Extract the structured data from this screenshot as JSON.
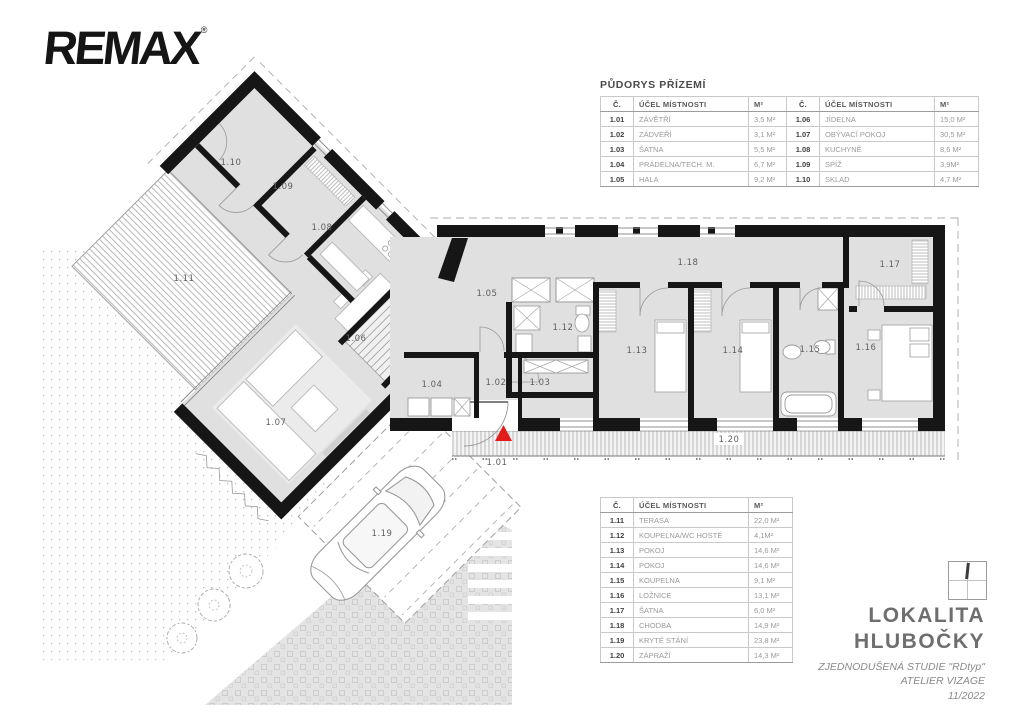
{
  "brand": {
    "logo_text": "REMAX",
    "registered_mark": "®"
  },
  "tables": {
    "title": "PŮDORYS PŘÍZEMÍ",
    "headers": {
      "num": "Č.",
      "purpose": "ÚČEL MÍSTNOSTI",
      "area": "M²"
    },
    "table1": {
      "rows": [
        {
          "n": "1.01",
          "p": "ZÁVĚTŘÍ",
          "a": "3,5 M²"
        },
        {
          "n": "1.02",
          "p": "ZÁDVEŘÍ",
          "a": "3,1 M²"
        },
        {
          "n": "1.03",
          "p": "ŠATNA",
          "a": "5,5 M²"
        },
        {
          "n": "1.04",
          "p": "PRÁDELNA/TECH. M.",
          "a": "6,7 M²"
        },
        {
          "n": "1.05",
          "p": "HALA",
          "a": "9,2 M²"
        }
      ]
    },
    "table2": {
      "rows": [
        {
          "n": "1.06",
          "p": "JÍDELNA",
          "a": "15,0 M²"
        },
        {
          "n": "1.07",
          "p": "OBÝVACÍ POKOJ",
          "a": "30,5 M²"
        },
        {
          "n": "1.08",
          "p": "KUCHYNĚ",
          "a": "8,6 M²"
        },
        {
          "n": "1.09",
          "p": "SPÍŽ",
          "a": "3,9M²"
        },
        {
          "n": "1.10",
          "p": "SKLAD",
          "a": "4,7 M²"
        }
      ]
    },
    "table3": {
      "rows": [
        {
          "n": "1.11",
          "p": "TERASA",
          "a": "22,0 M²"
        },
        {
          "n": "1.12",
          "p": "KOUPELNA/WC HOSTÉ",
          "a": "4,1M²"
        },
        {
          "n": "1.13",
          "p": "POKOJ",
          "a": "14,6 M²"
        },
        {
          "n": "1.14",
          "p": "POKOJ",
          "a": "14,6 M²"
        },
        {
          "n": "1.15",
          "p": "KOUPELNA",
          "a": "9,1 M²"
        },
        {
          "n": "1.16",
          "p": "LOŽNICE",
          "a": "13,1 M²"
        },
        {
          "n": "1.17",
          "p": "ŠATNA",
          "a": "6,0 M²"
        },
        {
          "n": "1.18",
          "p": "CHODBA",
          "a": "14,9 M²"
        },
        {
          "n": "1.19",
          "p": "KRYTÉ STÁNÍ",
          "a": "23,8 M²"
        },
        {
          "n": "1.20",
          "p": "ZÁPRAŽÍ",
          "a": "14,3 M²"
        }
      ]
    }
  },
  "plan": {
    "rooms": {
      "r101": "1.01",
      "r102": "1.02",
      "r103": "1.03",
      "r104": "1.04",
      "r105": "1.05",
      "r106": "1.06",
      "r107": "1.07",
      "r108": "1.08",
      "r109": "1.09",
      "r110": "1.10",
      "r111": "1.11",
      "r112": "1.12",
      "r113": "1.13",
      "r114": "1.14",
      "r115": "1.15",
      "r116": "1.16",
      "r117": "1.17",
      "r118": "1.18",
      "r119": "1.19",
      "r120": "1.20"
    },
    "colors": {
      "wall": "#161616",
      "floor": "#e0e0e0",
      "entrance_marker": "#e21b1b",
      "label": "#5f5f5f"
    }
  },
  "footer": {
    "location_line1": "LOKALITA",
    "location_line2": "HLUBOČKY",
    "study_line": "ZJEDNODUŠENÁ STUDIE \"RDtyp\"",
    "atelier_line": "ATELIER VIZAGE",
    "date_line": "11/2022"
  }
}
